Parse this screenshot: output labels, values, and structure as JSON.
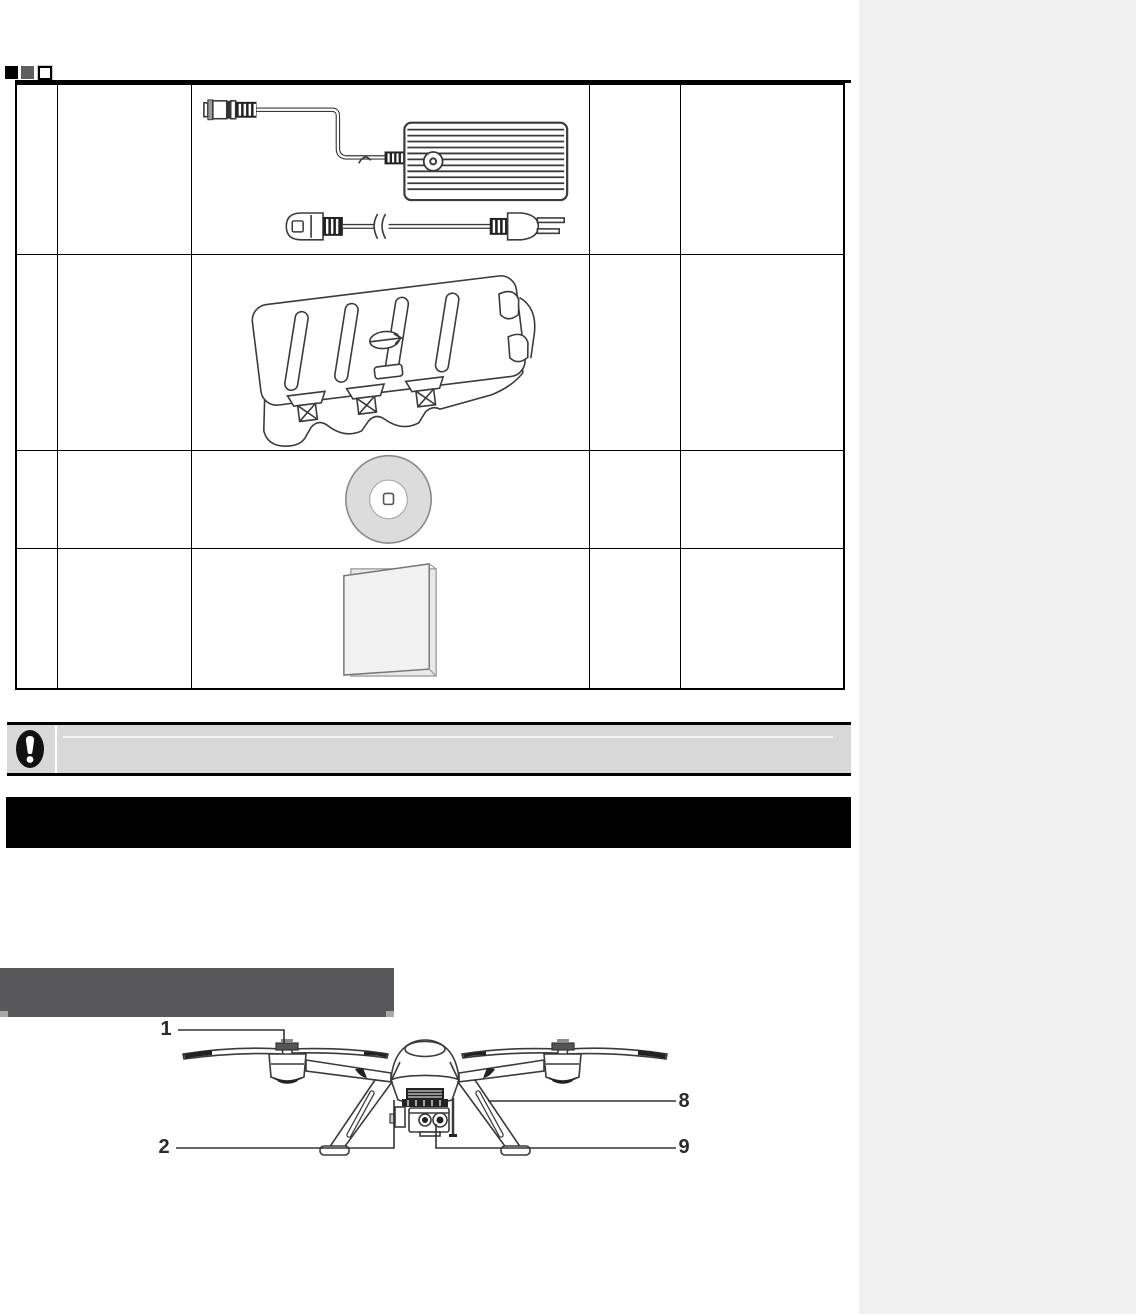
{
  "page": {
    "kind": "product-manual-page",
    "background": "#ffffff",
    "viewer_background": "#f1f1f2"
  },
  "colors": {
    "table_border": "#000000",
    "notice_bg": "#d8d8d8",
    "section_bar_bg": "#000000",
    "subsection_bar_bg": "#58585a",
    "line_art": "#3a3a3a",
    "disc_fill": "#dcdcdc",
    "booklet_fill": "#f2f2f2"
  },
  "page_markers": {
    "items": [
      {
        "name": "filled-black-square"
      },
      {
        "name": "filled-gray-square"
      },
      {
        "name": "outlined-white-square"
      }
    ]
  },
  "parts_table": {
    "column_count": 5,
    "rows": [
      {
        "illustration": "battery-charger-with-dc-connector-and-ac-power-cord",
        "cells": [
          "",
          "",
          "",
          ""
        ]
      },
      {
        "illustration": "hard-carrying-case",
        "cells": [
          "",
          "",
          "",
          ""
        ]
      },
      {
        "illustration": "software-cd-disc",
        "cells": [
          "",
          "",
          "",
          ""
        ]
      },
      {
        "illustration": "printed-manual-booklet",
        "cells": [
          "",
          "",
          "",
          ""
        ]
      }
    ]
  },
  "notice_bar": {
    "icon": "exclamation-circle-icon",
    "text": ""
  },
  "section_header_bar": {
    "text": ""
  },
  "subsection_header_bar": {
    "text": ""
  },
  "drone_figure": {
    "illustration": "quadcopter-front-view",
    "callouts": [
      {
        "label": "1",
        "target": "propeller"
      },
      {
        "label": "2",
        "target": "gimbal-mount"
      },
      {
        "label": "8",
        "target": "landing-skid"
      },
      {
        "label": "9",
        "target": "gimbal-camera"
      }
    ]
  }
}
